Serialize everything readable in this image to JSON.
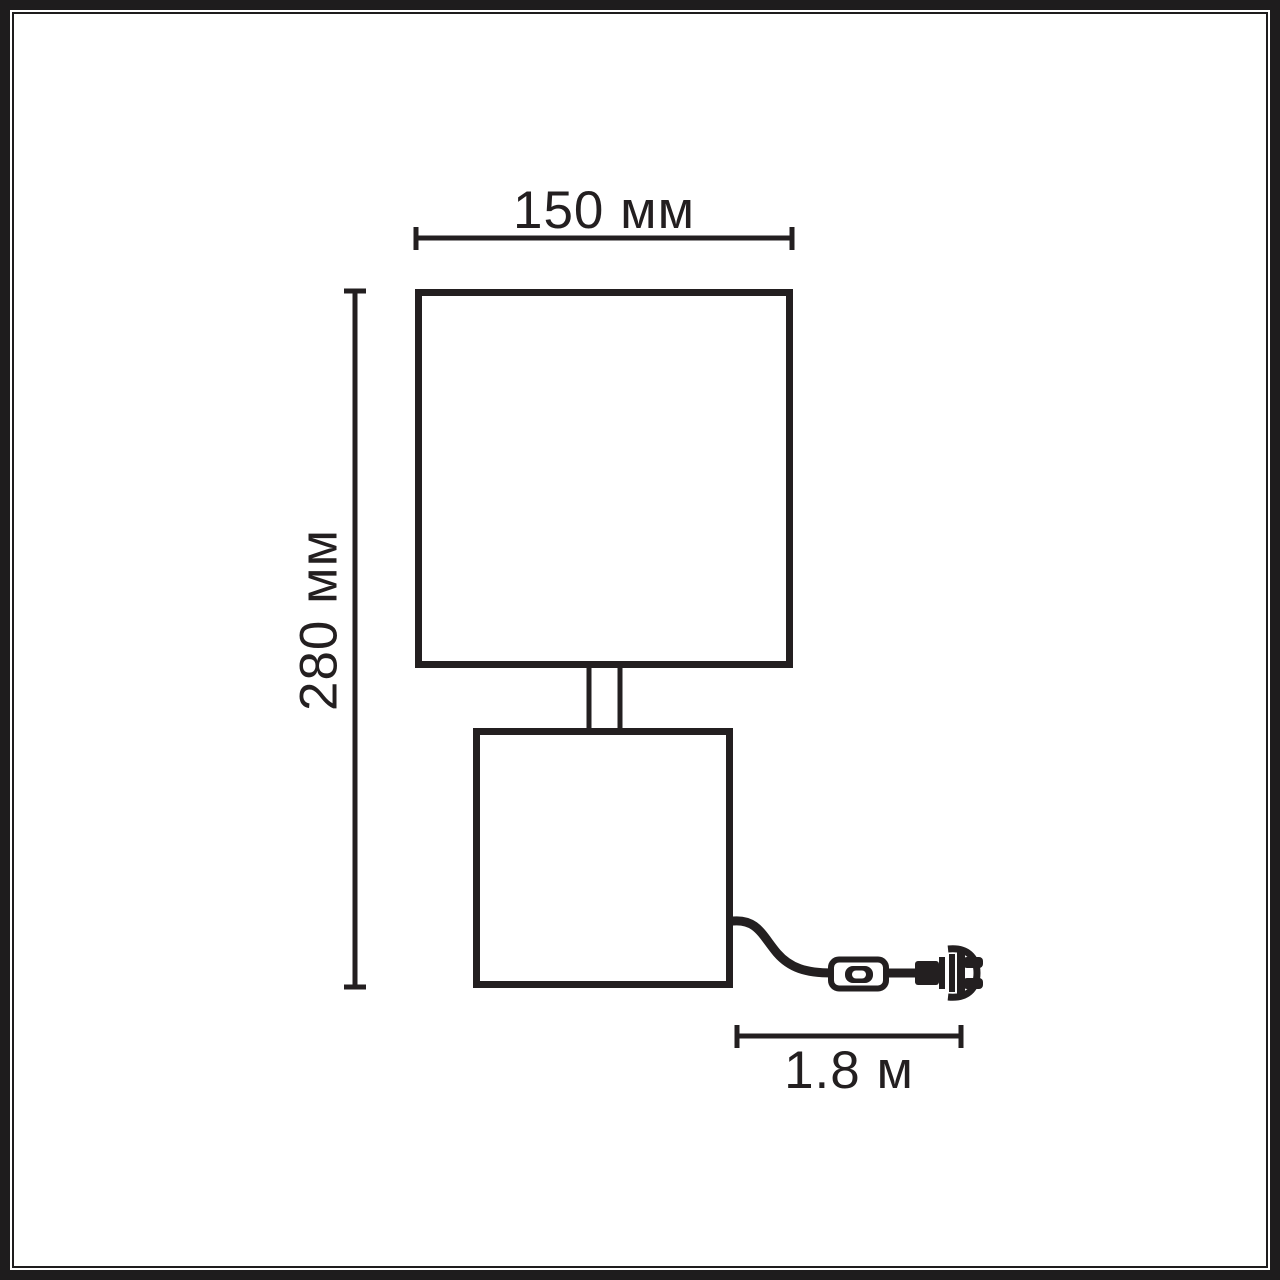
{
  "diagram": {
    "type": "product-dimension-drawing",
    "subject": "table-lamp",
    "labels": {
      "shade_width": "150 мм",
      "total_height": "280 мм",
      "cord_length": "1.8 м"
    },
    "colors": {
      "line": "#231f20",
      "background": "#ffffff"
    },
    "parts": [
      "lampshade",
      "lamp-stem",
      "lamp-base",
      "power-cord",
      "inline-switch",
      "power-plug"
    ]
  }
}
